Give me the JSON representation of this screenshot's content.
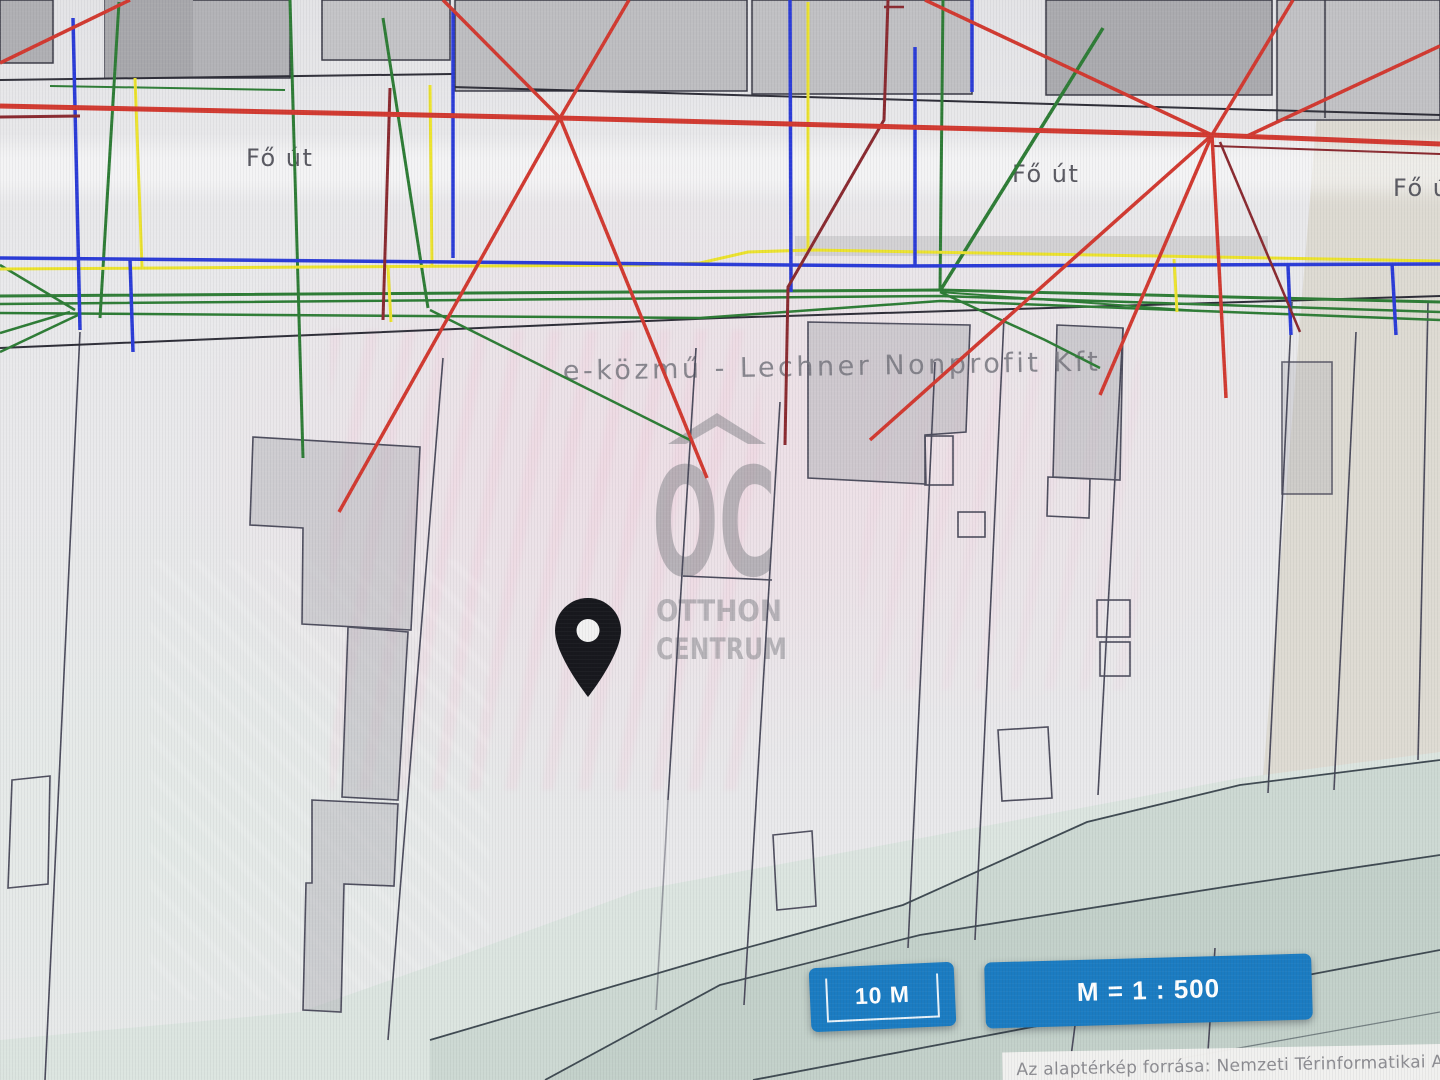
{
  "map": {
    "street_labels": [
      {
        "text": "Fő út"
      },
      {
        "text": "Fő út"
      },
      {
        "text": "Fő út"
      }
    ],
    "watermark_provider": "e-közmű - Lechner Nonprofit Kft",
    "brand_watermark": {
      "initials": "OC",
      "word1": "OTTHON",
      "word2": "CENTRUM"
    },
    "marker": "location-pin"
  },
  "controls": {
    "scale_bar_label": "10 M",
    "scale_ratio_label": "M = 1 : 500"
  },
  "attribution": "Az alaptérkép forrása: Nemzeti Térinformatikai Al",
  "colors": {
    "utility_red": "#d23a31",
    "utility_maroon": "#8a2a30",
    "utility_blue": "#2b3cd8",
    "utility_yellow": "#ece32e",
    "utility_green": "#2e7d36",
    "parcel_line": "#4b4b5c",
    "building_fill": "#b9b9bd",
    "road_teal": "#cdd9d3",
    "road_tan": "#d6cfbf",
    "button_blue": "#1b7cc2",
    "watermark_gray": "#8f8f96",
    "attribution_text": "#8d8d92"
  }
}
